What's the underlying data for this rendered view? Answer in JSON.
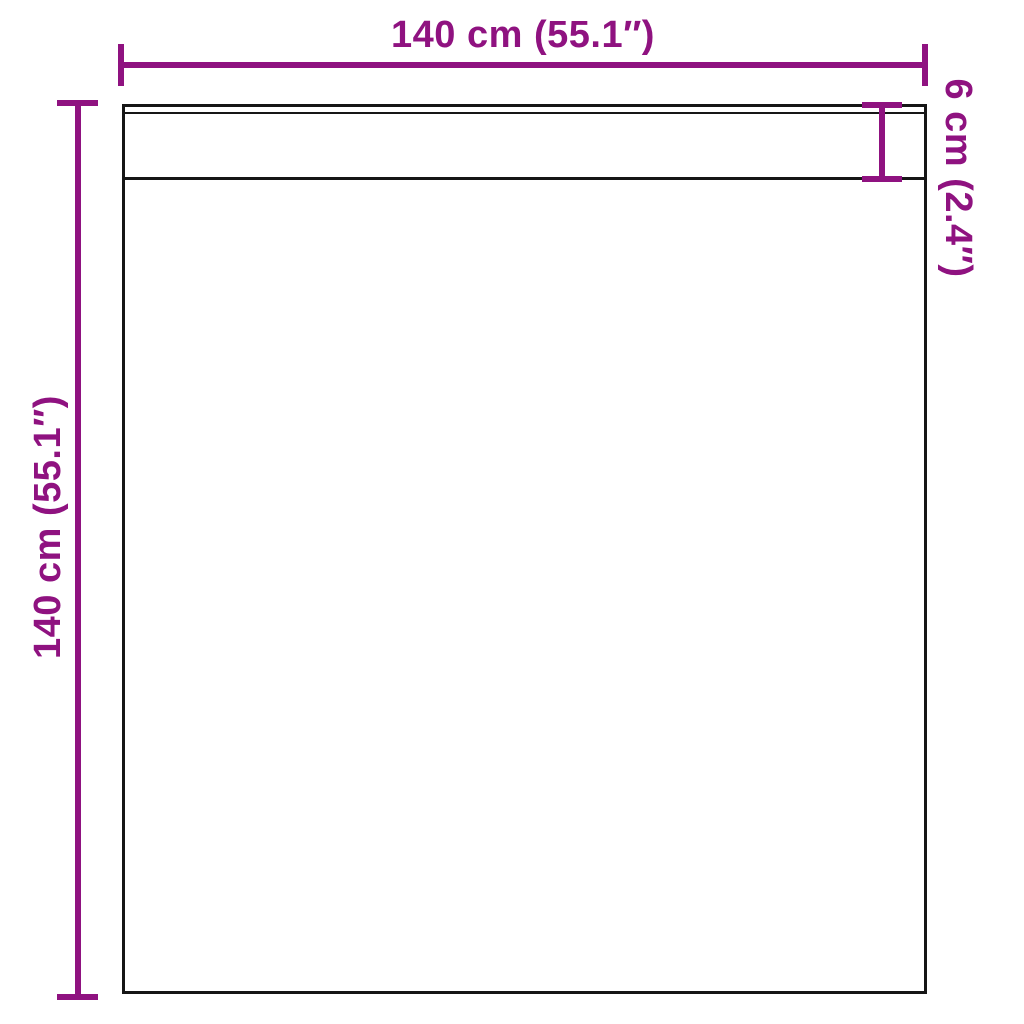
{
  "diagram": {
    "name": "product-dimension-diagram",
    "labels": {
      "width": "140 cm (55.1″)",
      "height": "140 cm (55.1″)",
      "hem": "6 cm (2.4″)"
    },
    "colors": {
      "dimension": "#8F1280",
      "outline": "#161616",
      "background": "#FFFFFF"
    }
  }
}
